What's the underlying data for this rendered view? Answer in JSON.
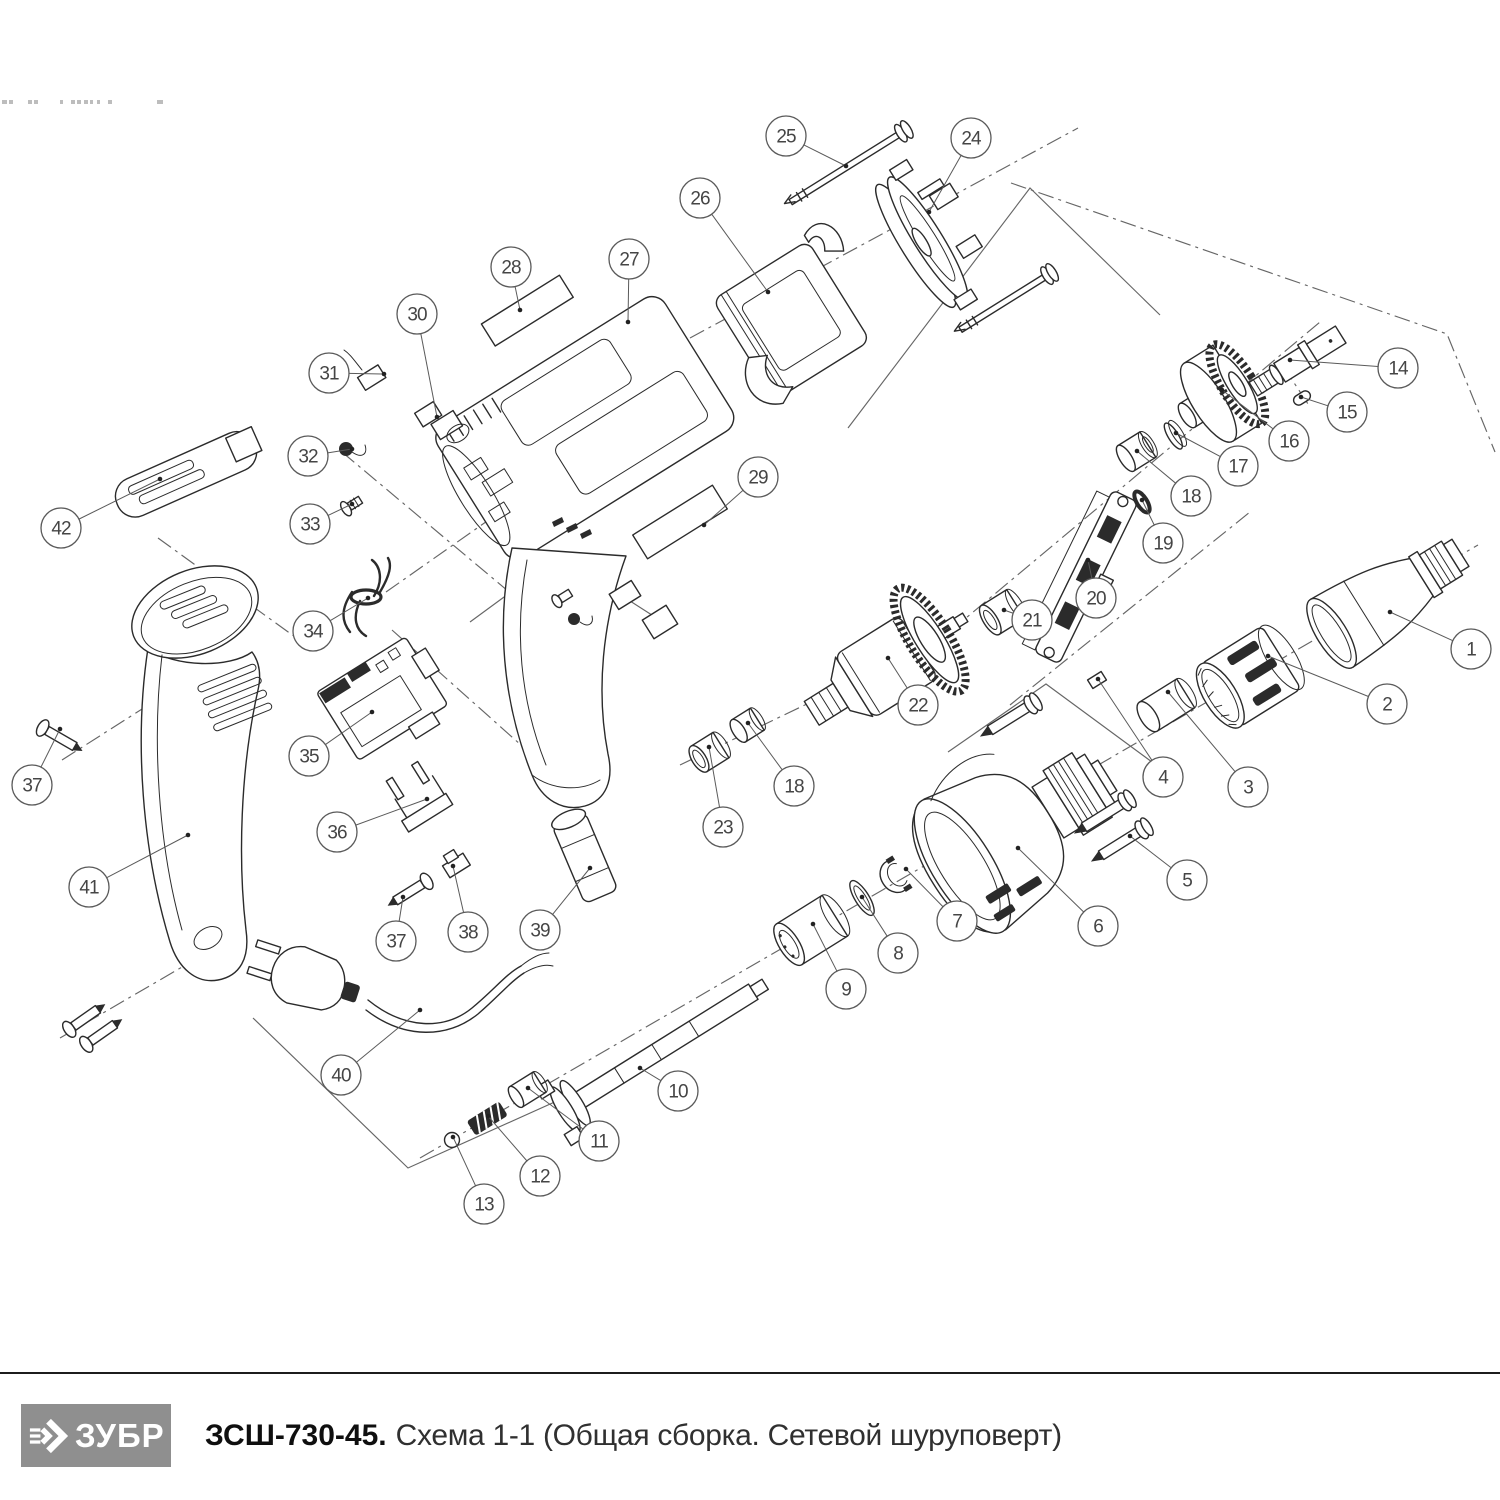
{
  "footer": {
    "brand": "ЗУБР",
    "model": "ЗСШ-730-45.",
    "caption": "Схема 1-1 (Общая сборка. Сетевой шуруповерт)"
  },
  "colors": {
    "line": "#2b2b2b",
    "callout": "#5a5a5a",
    "logo_bg": "#8f8f8f",
    "divider": "#1c1c1c"
  },
  "diagram": {
    "callout_radius": 20,
    "callouts": [
      {
        "label": "1",
        "x": 1471,
        "y": 649,
        "tx": 1390,
        "ty": 612
      },
      {
        "label": "2",
        "x": 1387,
        "y": 704,
        "tx": 1268,
        "ty": 656
      },
      {
        "label": "3",
        "x": 1248,
        "y": 787,
        "tx": 1168,
        "ty": 692
      },
      {
        "label": "4",
        "x": 1163,
        "y": 777,
        "tx": 1098,
        "ty": 679
      },
      {
        "label": "5",
        "x": 1187,
        "y": 880,
        "tx": 1130,
        "ty": 836
      },
      {
        "label": "6",
        "x": 1098,
        "y": 926,
        "tx": 1018,
        "ty": 848
      },
      {
        "label": "7",
        "x": 957,
        "y": 921,
        "tx": 906,
        "ty": 869
      },
      {
        "label": "8",
        "x": 898,
        "y": 953,
        "tx": 862,
        "ty": 897
      },
      {
        "label": "9",
        "x": 846,
        "y": 989,
        "tx": 813,
        "ty": 924
      },
      {
        "label": "10",
        "x": 678,
        "y": 1091,
        "tx": 640,
        "ty": 1068
      },
      {
        "label": "11",
        "x": 599,
        "y": 1141,
        "tx": 528,
        "ty": 1088
      },
      {
        "label": "12",
        "x": 540,
        "y": 1176,
        "tx": 488,
        "ty": 1116
      },
      {
        "label": "13",
        "x": 484,
        "y": 1204,
        "tx": 453,
        "ty": 1137
      },
      {
        "label": "14",
        "x": 1398,
        "y": 368,
        "tx": 1290,
        "ty": 360
      },
      {
        "label": "15",
        "x": 1347,
        "y": 412,
        "tx": 1301,
        "ty": 397
      },
      {
        "label": "16",
        "x": 1289,
        "y": 441,
        "tx": 1222,
        "ty": 390
      },
      {
        "label": "17",
        "x": 1238,
        "y": 466,
        "tx": 1176,
        "ty": 433
      },
      {
        "label": "18",
        "x": 1191,
        "y": 496,
        "tx": 1137,
        "ty": 451
      },
      {
        "label": "19",
        "x": 1163,
        "y": 543,
        "tx": 1142,
        "ty": 500
      },
      {
        "label": "20",
        "x": 1096,
        "y": 598,
        "tx": 1088,
        "ty": 560
      },
      {
        "label": "21",
        "x": 1032,
        "y": 620,
        "tx": 1004,
        "ty": 610
      },
      {
        "label": "22",
        "x": 918,
        "y": 705,
        "tx": 888,
        "ty": 658
      },
      {
        "label": "23",
        "x": 723,
        "y": 827,
        "tx": 709,
        "ty": 747
      },
      {
        "label": "18",
        "x": 794,
        "y": 786,
        "tx": 748,
        "ty": 723
      },
      {
        "label": "24",
        "x": 971,
        "y": 138,
        "tx": 929,
        "ty": 212
      },
      {
        "label": "25",
        "x": 786,
        "y": 136,
        "tx": 846,
        "ty": 166
      },
      {
        "label": "26",
        "x": 700,
        "y": 198,
        "tx": 768,
        "ty": 292
      },
      {
        "label": "27",
        "x": 629,
        "y": 259,
        "tx": 628,
        "ty": 322
      },
      {
        "label": "28",
        "x": 511,
        "y": 267,
        "tx": 520,
        "ty": 310
      },
      {
        "label": "29",
        "x": 758,
        "y": 477,
        "tx": 704,
        "ty": 525
      },
      {
        "label": "30",
        "x": 417,
        "y": 314,
        "tx": 437,
        "ty": 417
      },
      {
        "label": "31",
        "x": 329,
        "y": 373,
        "tx": 384,
        "ty": 374
      },
      {
        "label": "32",
        "x": 308,
        "y": 456,
        "tx": 352,
        "ty": 449
      },
      {
        "label": "33",
        "x": 310,
        "y": 524,
        "tx": 352,
        "ty": 504
      },
      {
        "label": "34",
        "x": 313,
        "y": 631,
        "tx": 368,
        "ty": 598
      },
      {
        "label": "35",
        "x": 309,
        "y": 756,
        "tx": 372,
        "ty": 712
      },
      {
        "label": "36",
        "x": 337,
        "y": 832,
        "tx": 427,
        "ty": 799
      },
      {
        "label": "37",
        "x": 32,
        "y": 785,
        "tx": 60,
        "ty": 729
      },
      {
        "label": "37",
        "x": 396,
        "y": 941,
        "tx": 403,
        "ty": 897
      },
      {
        "label": "38",
        "x": 468,
        "y": 932,
        "tx": 453,
        "ty": 866
      },
      {
        "label": "39",
        "x": 540,
        "y": 930,
        "tx": 590,
        "ty": 868
      },
      {
        "label": "40",
        "x": 341,
        "y": 1075,
        "tx": 420,
        "ty": 1010
      },
      {
        "label": "41",
        "x": 89,
        "y": 887,
        "tx": 188,
        "ty": 835
      },
      {
        "label": "42",
        "x": 61,
        "y": 528,
        "tx": 160,
        "ty": 479
      }
    ]
  }
}
